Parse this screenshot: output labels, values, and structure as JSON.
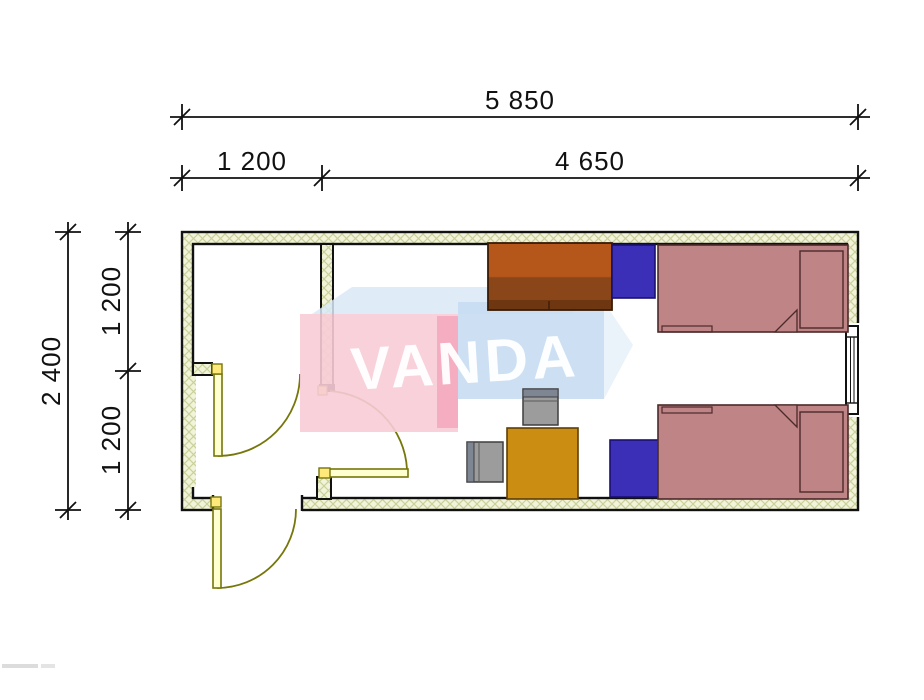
{
  "drawing": {
    "type": "container-floor-plan"
  },
  "dimensions": {
    "top_total": "5 850",
    "top_left": "1 200",
    "top_right": "4 650",
    "left_total": "2 400",
    "left_upper": "1 200",
    "left_lower": "1 200"
  },
  "watermark": {
    "brand": "VANDA"
  },
  "colors": {
    "outline": "#111111",
    "wall_fill": "#f2f3d9",
    "wall_hatch": "#c9d19b",
    "door_line": "#76760a",
    "door_leaf_fill": "#ffffd0",
    "hinge_fill": "#ffe97a",
    "bed": "#bf8486",
    "bed_outline": "#4c2a2a",
    "wardrobe_top": "#b5571a",
    "wardrobe_bottom": "#8a4519",
    "nightstand": "#3b2fb8",
    "desk": "#cc8e12",
    "chair": "#9c9c9c",
    "chair_accent": "#7d8692",
    "watermark_pink": "#f7ccd6",
    "watermark_pink_edge": "#f3a9be",
    "watermark_blue": "#c6dcf2",
    "watermark_blue_side": "#e8f1fa",
    "watermark_top_face": "#d9e9f7",
    "watermark_text": "#ffffff"
  }
}
